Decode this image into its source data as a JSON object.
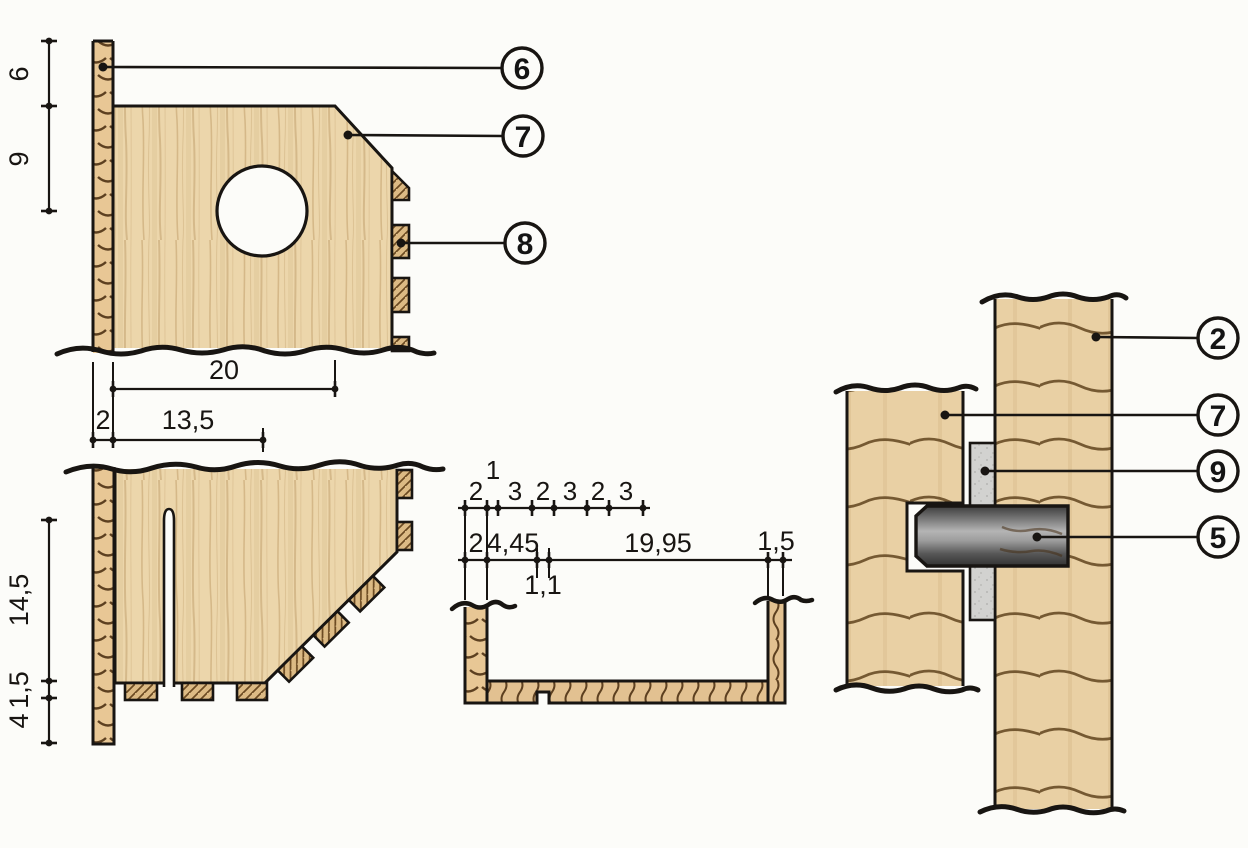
{
  "drawing": {
    "kind": "woodworking construction drawing",
    "colors": {
      "background": "#fcfcf9",
      "line": "#181512",
      "wood_face": "#ecd6ab",
      "wood_side": "#e9d0a4",
      "wood_end": "#e8c795",
      "grain_dark": "#5d4020",
      "hatch_wood": "#dcba84",
      "spacer_gray": "#d2d2d0",
      "dowel_dark": "#3c3c3c",
      "dowel_light": "#b4b4b4"
    }
  },
  "views": {
    "front_panel": {
      "name": "front panel with entrance hole",
      "callouts": [
        {
          "label": "6"
        },
        {
          "label": "7"
        },
        {
          "label": "8"
        }
      ],
      "dim_vertical": [
        {
          "label": "6"
        },
        {
          "label": "9"
        }
      ],
      "dim_horizontal": [
        {
          "label": "20"
        },
        {
          "label": "2"
        },
        {
          "label": "13,5"
        }
      ]
    },
    "side_panel": {
      "name": "side panel with slot and finger joints",
      "dim_vertical": [
        {
          "label": "14,5"
        },
        {
          "label": "1,5"
        },
        {
          "label": "4"
        }
      ]
    },
    "tray_section": {
      "name": "bottom tray cross-section",
      "dim_row_top": [
        {
          "label": "2"
        },
        {
          "label": "1"
        },
        {
          "label": "3"
        },
        {
          "label": "2"
        },
        {
          "label": "3"
        },
        {
          "label": "2"
        },
        {
          "label": "3"
        }
      ],
      "dim_row_main": [
        {
          "label": "2"
        },
        {
          "label": "4,45"
        },
        {
          "label": "19,95"
        },
        {
          "label": "1,5"
        }
      ],
      "dim_row_bottom": [
        {
          "label": "1,1"
        }
      ]
    },
    "joint_detail": {
      "name": "dowel joint detail",
      "callouts": [
        {
          "label": "2"
        },
        {
          "label": "7"
        },
        {
          "label": "9"
        },
        {
          "label": "5"
        }
      ]
    }
  }
}
